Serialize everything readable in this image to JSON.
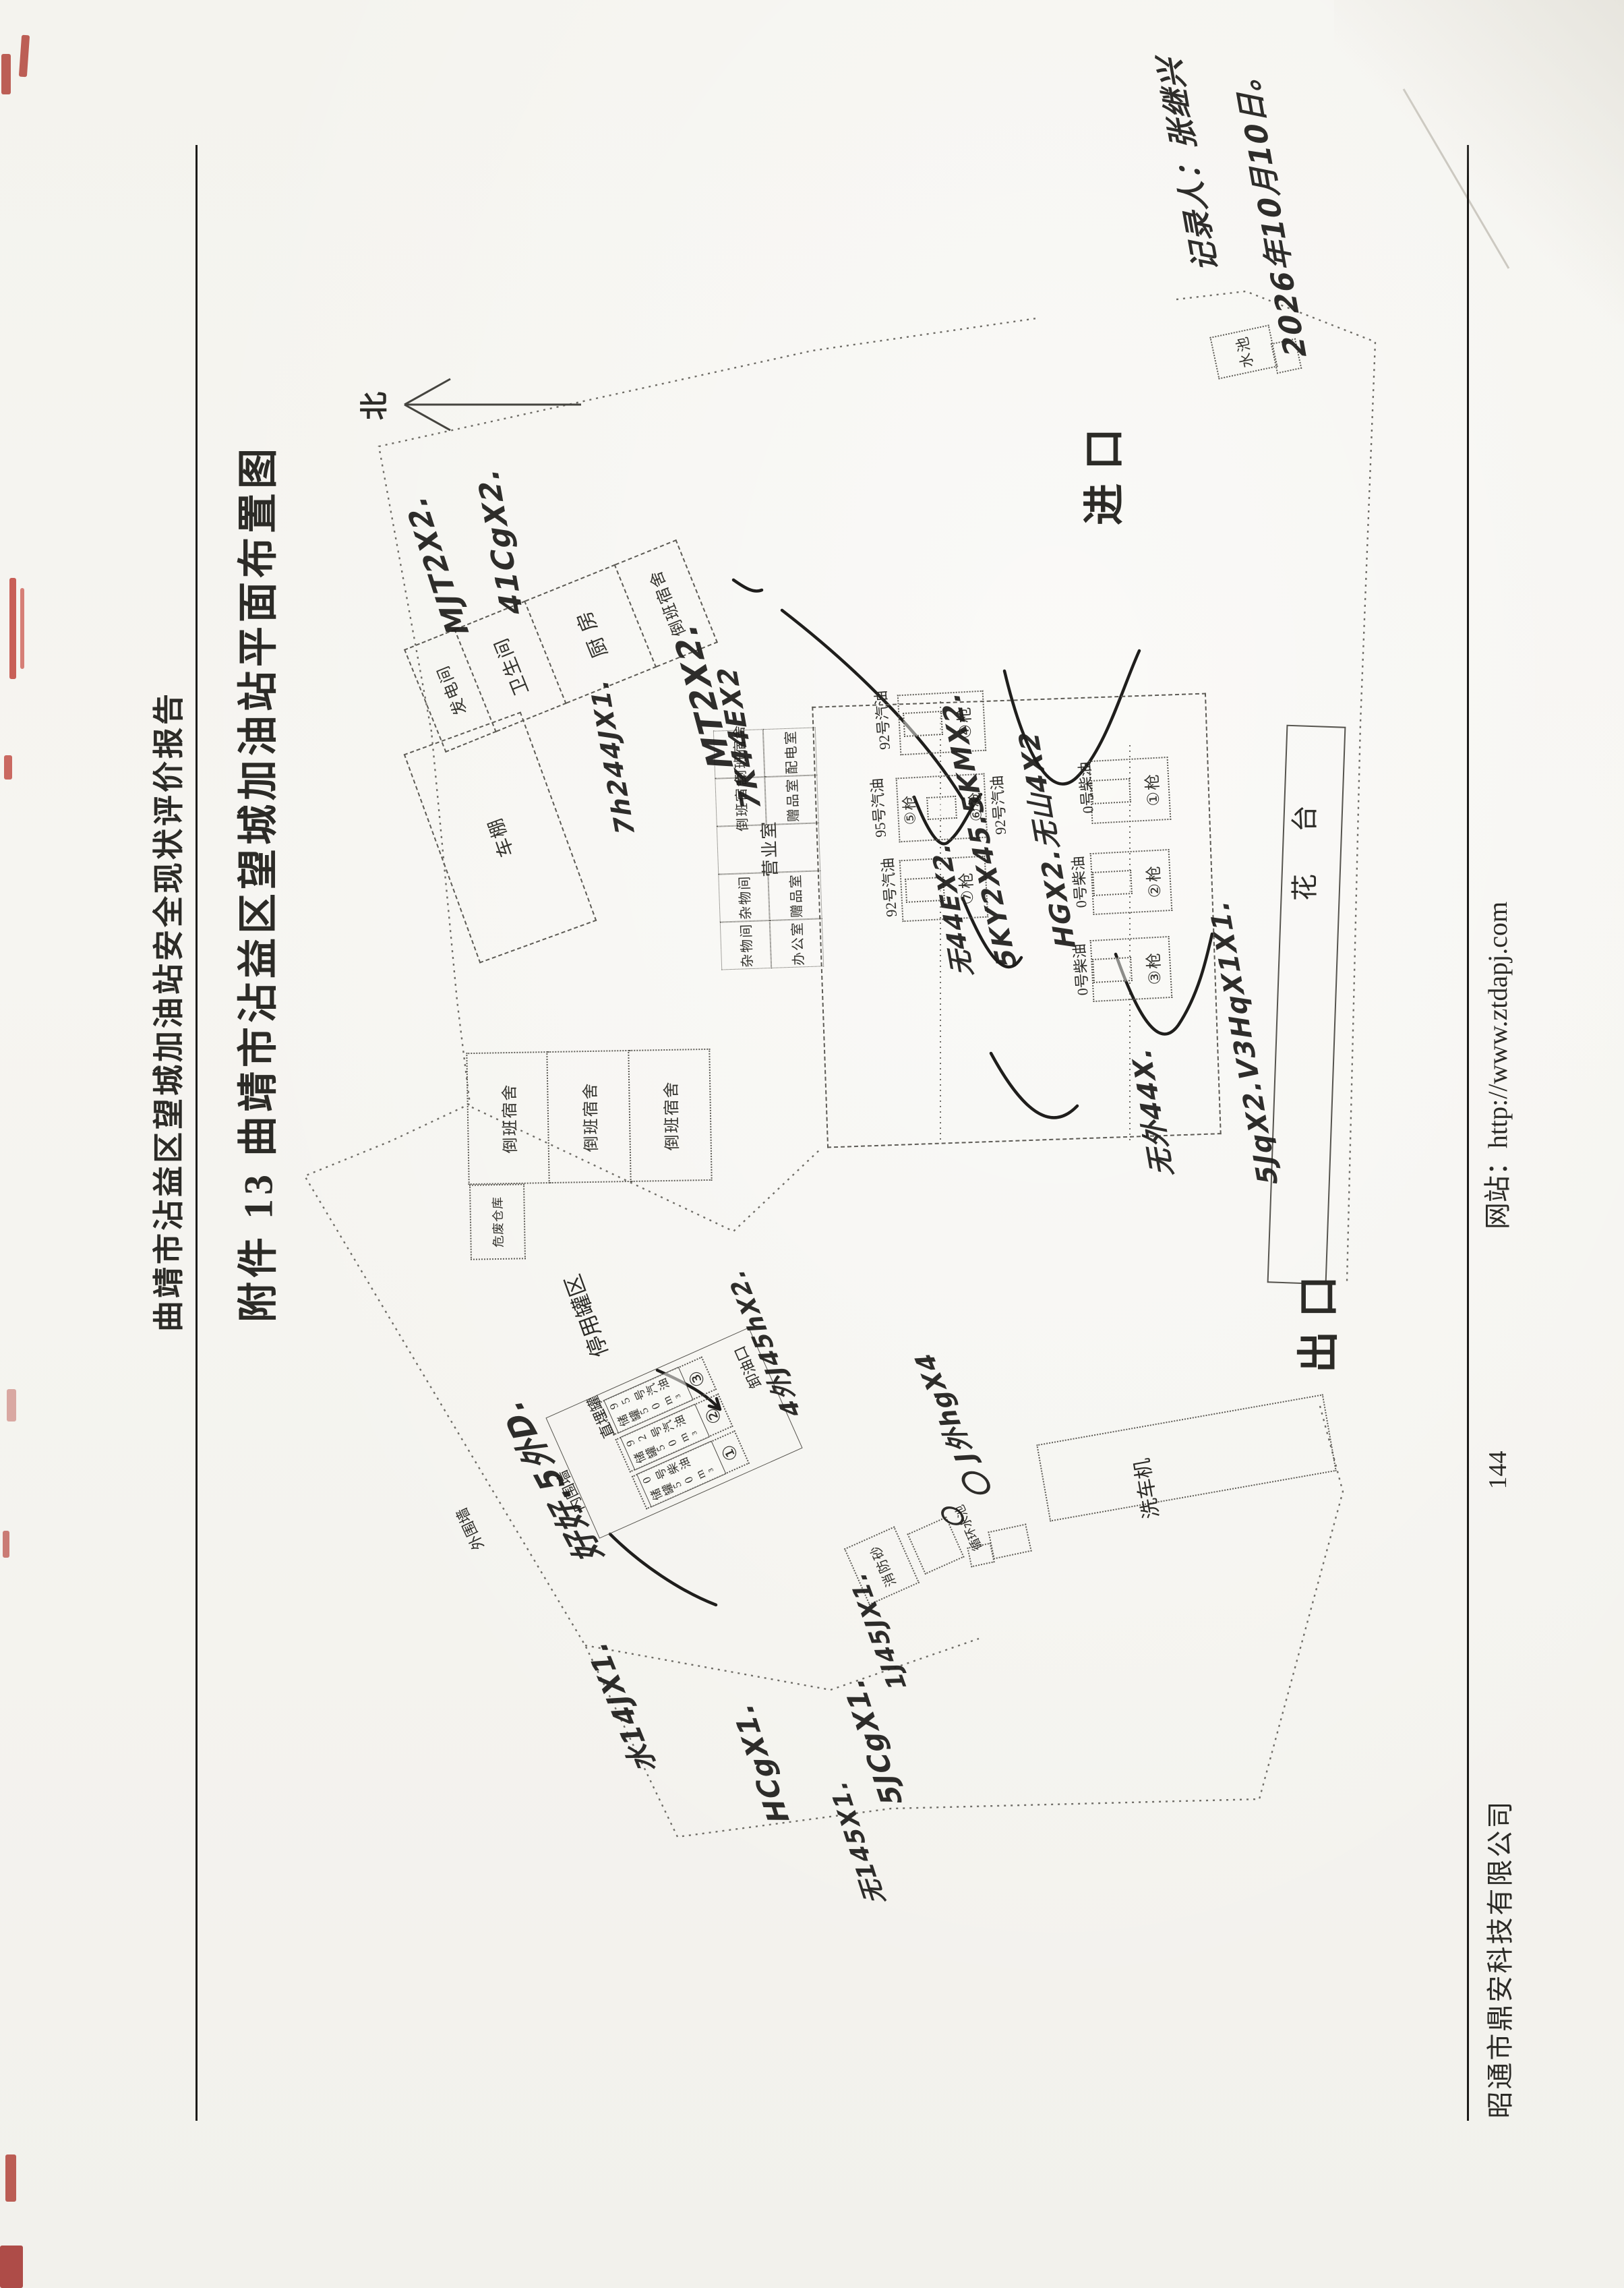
{
  "page": {
    "header_title": "曲靖市沾益区望城加油站安全现状评价报告",
    "doc_title": "附件 13 曲靖市沾益区望城加油站平面布置图",
    "footer": {
      "company": "昭通市鼎安科技有限公司",
      "page_number": "144",
      "website": "网站：http://www.ztdapj.com"
    }
  },
  "compass": {
    "north_label": "北"
  },
  "labels": {
    "entrance": "进口",
    "exit": "出口",
    "flower_bed": "花 台",
    "water_pool": "水池",
    "car_wash": "洗车机",
    "fire_sand": "消防砂",
    "circulating_pool": "循环水池",
    "unloading_point": "卸油口",
    "buried_tank": "直埋罐",
    "disused_tank_area": "停用罐区",
    "inner_wall": "内围墙",
    "outer_wall": "外围墙",
    "hazwaste_store": "危废仓库",
    "carport": "车棚"
  },
  "service_building_top": {
    "rooms": [
      "发电间",
      "卫生间",
      "厨 房",
      "倒班宿舍"
    ]
  },
  "station_building": {
    "cells": [
      "倒班宿舍",
      "配电室",
      "倒班宿舍",
      "赠品室",
      "营业室",
      "杂物间",
      "赠品室",
      "杂物间",
      "办公室"
    ]
  },
  "dorm_row": {
    "rooms": [
      "倒班宿舍",
      "倒班宿舍",
      "倒班宿舍"
    ]
  },
  "dispenser_islands": [
    {
      "id": "island-4",
      "guns": [
        "④枪"
      ],
      "fuel_left": "92号汽油",
      "fuel_right": ""
    },
    {
      "id": "island-5-6",
      "guns": [
        "⑤枪",
        "⑥枪"
      ],
      "fuel_left": "95号汽油",
      "fuel_right": "92号汽油"
    },
    {
      "id": "island-7",
      "guns": [
        "⑦枪"
      ],
      "fuel_left": "92号汽油",
      "fuel_right": ""
    },
    {
      "id": "island-1",
      "guns": [
        "①枪"
      ],
      "fuel_left": "0号柴油",
      "fuel_right": ""
    },
    {
      "id": "island-2",
      "guns": [
        "②枪"
      ],
      "fuel_left": "0号柴油",
      "fuel_right": ""
    },
    {
      "id": "island-3",
      "guns": [
        "③枪"
      ],
      "fuel_left": "0号柴油",
      "fuel_right": ""
    }
  ],
  "storage_tanks": [
    {
      "num": "③",
      "line1": "95号汽油",
      "line2": "储罐50m³"
    },
    {
      "num": "②",
      "line1": "92号汽油",
      "line2": "储罐50m³"
    },
    {
      "num": "①",
      "line1": "0号柴油",
      "line2": "储罐50m³"
    }
  ],
  "hw": [
    "MJT2X2.",
    "41CgX2.",
    "7h244JX1.",
    "MT2X2.",
    "7K44EX2",
    "HGX2.无山4X2",
    "5KY2X45.5KMX2.",
    "无44EX2.",
    "5JqX2.V3HqX1X1.",
    "无外44X.",
    "J外hgX4",
    "4外J45hX2.",
    "好好.5外D.",
    "水14JX1.",
    "HCgX1.",
    "5JCgX1.",
    "1J45JX1.",
    "无145X1.",
    "记录人：张继兴",
    "2026年10月10日。",
    "〇",
    "〇"
  ]
}
